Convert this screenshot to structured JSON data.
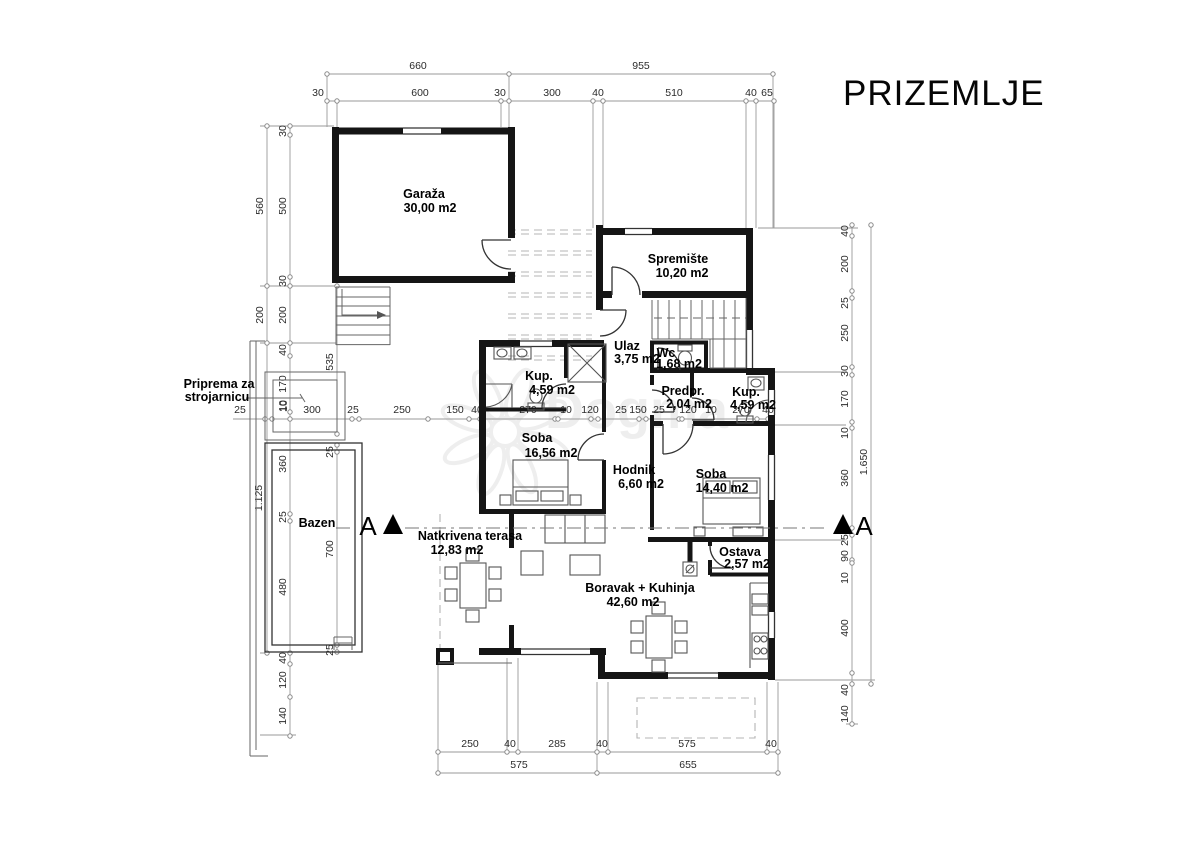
{
  "title": "PRIZEMLJE",
  "watermark": "Dogma",
  "section_label": "A",
  "rooms": {
    "garaza": {
      "name": "Garaža",
      "area": "30,00 m2"
    },
    "spremiste": {
      "name": "Spremište",
      "area": "10,20 m2"
    },
    "ulaz": {
      "name": "Ulaz",
      "area": "3,75 m2"
    },
    "wc": {
      "name": "Wc",
      "area": "1,68 m2"
    },
    "kup1": {
      "name": "Kup.",
      "area": "4,59 m2"
    },
    "predpr": {
      "name": "Predpr.",
      "area": "2,04 m2"
    },
    "kup2": {
      "name": "Kup.",
      "area": "4,59 m2"
    },
    "soba1": {
      "name": "Soba",
      "area": "16,56 m2"
    },
    "hodnik": {
      "name": "Hodnik",
      "area": "6,60 m2"
    },
    "soba2": {
      "name": "Soba",
      "area": "14,40 m2"
    },
    "terasa": {
      "name": "Natkrivena terasa",
      "area": "12,83 m2"
    },
    "boravak": {
      "name": "Boravak + Kuhinja",
      "area": "42,60 m2"
    },
    "ostava": {
      "name": "Ostava",
      "area": "2,57 m2"
    },
    "bazen": {
      "name": "Bazen"
    },
    "strojarnica": {
      "line1": "Priprema za",
      "line2": "strojarnicu"
    }
  },
  "dims": {
    "top1": [
      "660",
      "955"
    ],
    "top2": [
      "30",
      "600",
      "30",
      "300",
      "40",
      "510",
      "40",
      "65"
    ],
    "left_outer": [
      "560",
      "200",
      "1.125"
    ],
    "left_inner": [
      "30",
      "500",
      "30",
      "200",
      "40",
      "170",
      "10",
      "360",
      "25",
      "480",
      "40",
      "120",
      "140"
    ],
    "pool_col": [
      "25",
      "700",
      "25",
      "535"
    ],
    "mid": [
      "25",
      "10",
      "300",
      "25",
      "250",
      "150",
      "40",
      "270",
      "10",
      "120",
      "25",
      "150",
      "25",
      "120",
      "10",
      "270",
      "40"
    ],
    "right_inner": [
      "40",
      "200",
      "25",
      "250",
      "30",
      "170",
      "10",
      "360",
      "25",
      "90",
      "10",
      "400",
      "40",
      "140"
    ],
    "right_outer": [
      "1.650"
    ],
    "bottom1": [
      "250",
      "40",
      "285",
      "40",
      "575",
      "40"
    ],
    "bottom2": [
      "575",
      "655"
    ]
  }
}
